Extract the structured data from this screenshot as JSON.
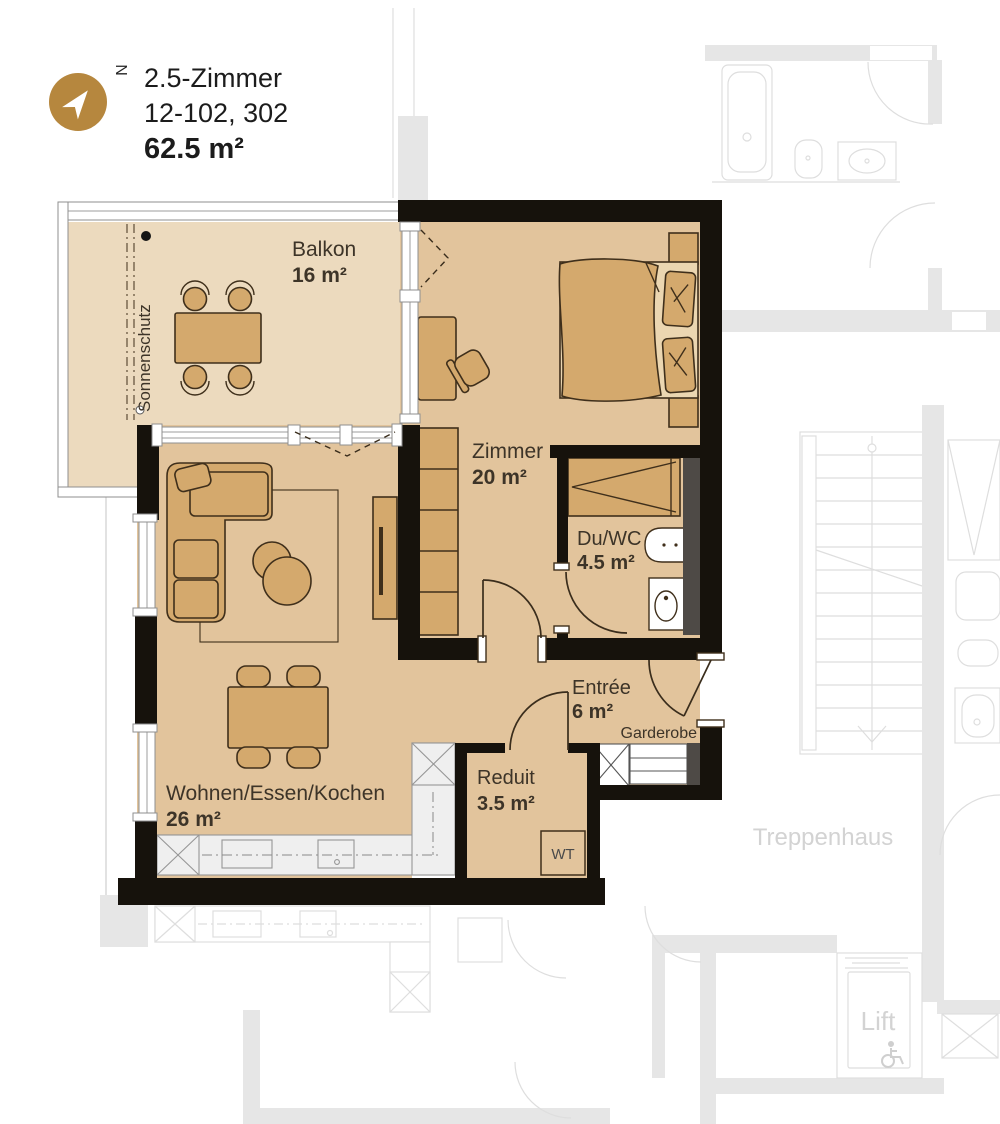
{
  "header": {
    "line1": "2.5-Zimmer",
    "line2": "12-102, 302",
    "line3": "62.5 m²",
    "north_letter": "N"
  },
  "rooms": {
    "balkon": {
      "name": "Balkon",
      "area": "16 m²"
    },
    "zimmer": {
      "name": "Zimmer",
      "area": "20 m²"
    },
    "duwc": {
      "name": "Du/WC",
      "area": "4.5 m²"
    },
    "entree": {
      "name": "Entrée",
      "area": "6 m²"
    },
    "wohnen": {
      "name": "Wohnen/Essen/Kochen",
      "area": "26 m²"
    },
    "reduit": {
      "name": "Reduit",
      "area": "3.5 m²"
    }
  },
  "annotations": {
    "sonnenschutz": "Sonnenschutz",
    "garderobe": "Garderobe",
    "wt": "WT"
  },
  "surroundings": {
    "treppenhaus": "Treppenhaus",
    "lift": "Lift"
  },
  "colors": {
    "accent_gold": "#b6873e",
    "floor_main": "#e2c49c",
    "floor_balcony": "#ecdabe",
    "furniture": "#d4a96d",
    "wall_black": "#16120c",
    "shaft_gray": "#4e4a46",
    "neighbor_gray": "#e6e6e6",
    "kitchen_gray": "#efefef"
  }
}
